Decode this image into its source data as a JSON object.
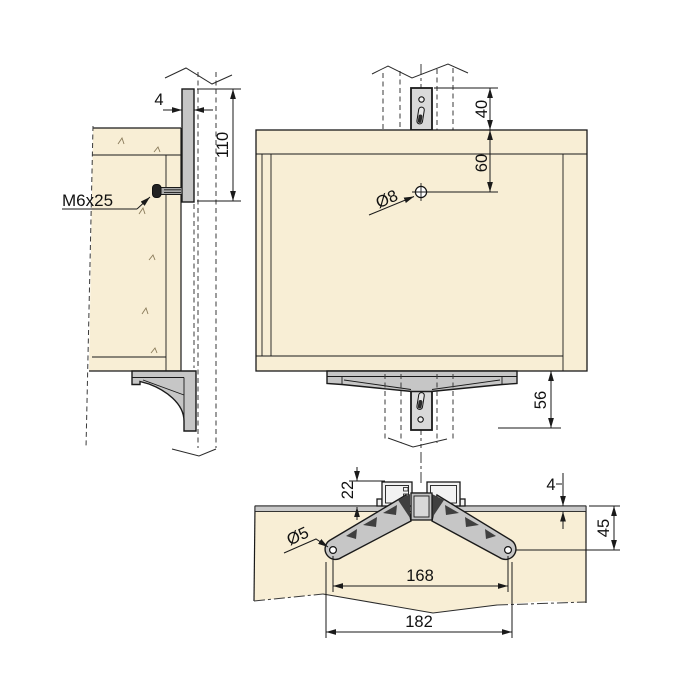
{
  "drawing": {
    "side_view": {
      "rail_thickness": "4",
      "rail_height": "110",
      "screw_label": "M6x25"
    },
    "front_view": {
      "rail_above_panel": "40",
      "hole_offset_from_top": "60",
      "hole_diameter": "Ø8",
      "rail_below_panel": "56"
    },
    "top_view": {
      "profile_depth": "22",
      "panel_edge_gap": "4",
      "screw_hole_diameter": "Ø5",
      "hole_to_front_edge": "45",
      "hole_spacing": "168",
      "bracket_width": "182"
    },
    "colors": {
      "panel_fill": "#f8eed5",
      "metal_fill": "#c6c6c6",
      "cutout_fill": "#3f3f3f",
      "line": "#1a1a1a"
    }
  }
}
